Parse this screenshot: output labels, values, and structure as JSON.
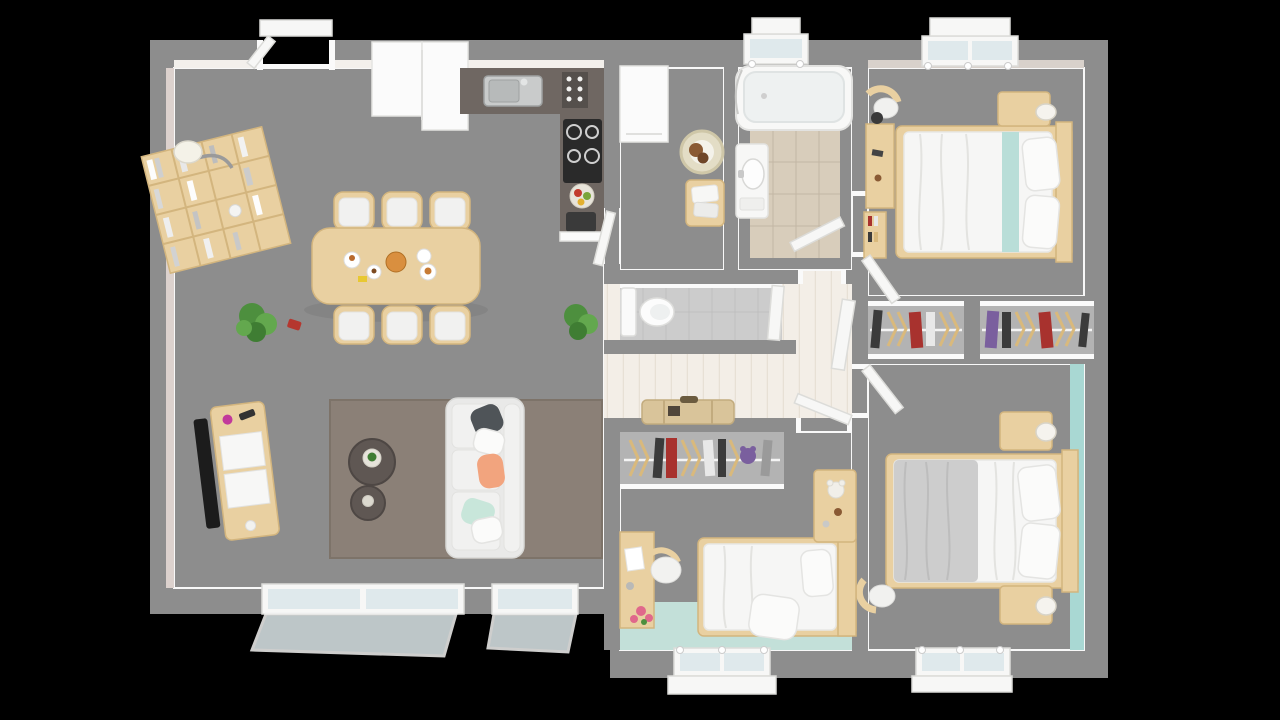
{
  "meta": {
    "kind": "3d-floorplan-top-down-render",
    "view": "bird's-eye interior render on black background",
    "visible_text": "none"
  },
  "palette": {
    "bg": "#000000",
    "wall": "#8d8d8d",
    "trim": "#fafafa",
    "floorWood": "#f3eee7",
    "plankLine": "#e7e0d5",
    "floorBedroom1": "#eae5e0",
    "floorBedroom2": "#ebe7e3",
    "floorKids": "#ebe8e4",
    "floorMint": "#c3e0d9",
    "tealWall": "#a9d8d3",
    "tealStripe": "#b9ded8",
    "bathTileBorder": "#edebe7",
    "bathTileCenter": "#d8cdbb",
    "wcTile": "#cccccc",
    "wood": "#e9d0a1",
    "woodDark": "#d3b57e",
    "counter": "#6f6762",
    "appliance": "#fbfbfb",
    "stove": "#2a2a2a",
    "rug": "#8b8077",
    "coffeeTable": "#5f5753",
    "sofa": "#e9e9e8",
    "bedding": "#f6f6f5",
    "blanketGray": "#cdcdcd",
    "closetInner": "#b3b3b3",
    "clothesDark": "#3b3b3b",
    "clothesRed": "#a8322e",
    "clothesPurple": "#7a5f9e",
    "clothesWhite": "#e8e8e8",
    "hangerTan": "#d9b97c",
    "plant": "#4d8f3e",
    "flowerPink": "#e0688b",
    "glass": "#dfe9ec",
    "tv": "#1c1c1c",
    "catBrown": "#8a5a34",
    "basketCream": "#e3ddc6",
    "pillowSlate": "#4f5458",
    "pillowPeach": "#f2a47e",
    "pillowMint": "#c8e6da",
    "suitcaseTan": "#d9c49a",
    "wallPinkLip": "#dcd1cd",
    "wallGreigeLip": "#d8d1cb"
  },
  "building": {
    "shape": "rectangular plan, living wing shallower at bottom-left",
    "wings": [
      "open living-dining-kitchen (left)",
      "utility + bathroom + wc (center)",
      "two bedrooms (right)",
      "kids bedroom (bottom center)"
    ],
    "doors": {
      "entry_top": 1,
      "interior_open_leaves": 7
    },
    "windows": {
      "north_wall": 2,
      "south_wall": 4
    }
  },
  "rooms": [
    {
      "id": "living-dining-kitchen",
      "label": "open living / dining / kitchen",
      "floor": "pale wood planks",
      "furniture": [
        "cube bookshelf with books",
        "floor lamp",
        "dining table",
        "six dining chairs",
        "breakfast dishes",
        "potted plant left",
        "potted plant right",
        "red watering can",
        "tv sideboard",
        "flat screen tv",
        "taupe area rug",
        "large round coffee table",
        "small round coffee table",
        "three-seat sofa",
        "five throw pillows",
        "dark kitchen counter with sink",
        "spice rack",
        "black cooktop",
        "fruit bowl",
        "coffee machine",
        "white tall cabinets / fridge",
        "sliding glass doors south"
      ]
    },
    {
      "id": "utility-room",
      "label": "utility room",
      "furniture": [
        "white appliance",
        "round pet basket with cat",
        "wood stool with towels"
      ]
    },
    {
      "id": "bathroom",
      "label": "bathroom",
      "furniture": [
        "bathtub along north wall",
        "washbasin vanity on west wall",
        "beige tiled floor",
        "north window"
      ]
    },
    {
      "id": "wc",
      "label": "separate toilet",
      "furniture": [
        "toilet with tank on west wall",
        "gray tiled floor",
        "door east"
      ]
    },
    {
      "id": "hallway",
      "label": "hall with fan of open white doors",
      "furniture": [
        "five open door leaves"
      ]
    },
    {
      "id": "bedroom-top-right",
      "label": "bedroom north-east",
      "furniture": [
        "double bed with white duvet",
        "teal runner on bed",
        "two pillows",
        "nightstand with lamp",
        "desk",
        "chair with jacket",
        "low bookshelf",
        "north window",
        "built-in wardrobe south"
      ]
    },
    {
      "id": "bedroom-bottom-right",
      "label": "master bedroom south-east",
      "furniture": [
        "double bed with gray blanket",
        "two pillows",
        "two nightstands with lamps",
        "chair",
        "teal accent wall east",
        "south window",
        "built-in wardrobe north"
      ]
    },
    {
      "id": "kids-bedroom",
      "label": "kids bedroom south-center",
      "furniture": [
        "single bed",
        "headboard shelf with teddy bear",
        "desk with chair",
        "pink flowers",
        "open wardrobe with hanging clothes",
        "suitcase on wardrobe shelf",
        "mint floor area",
        "south window"
      ]
    }
  ]
}
